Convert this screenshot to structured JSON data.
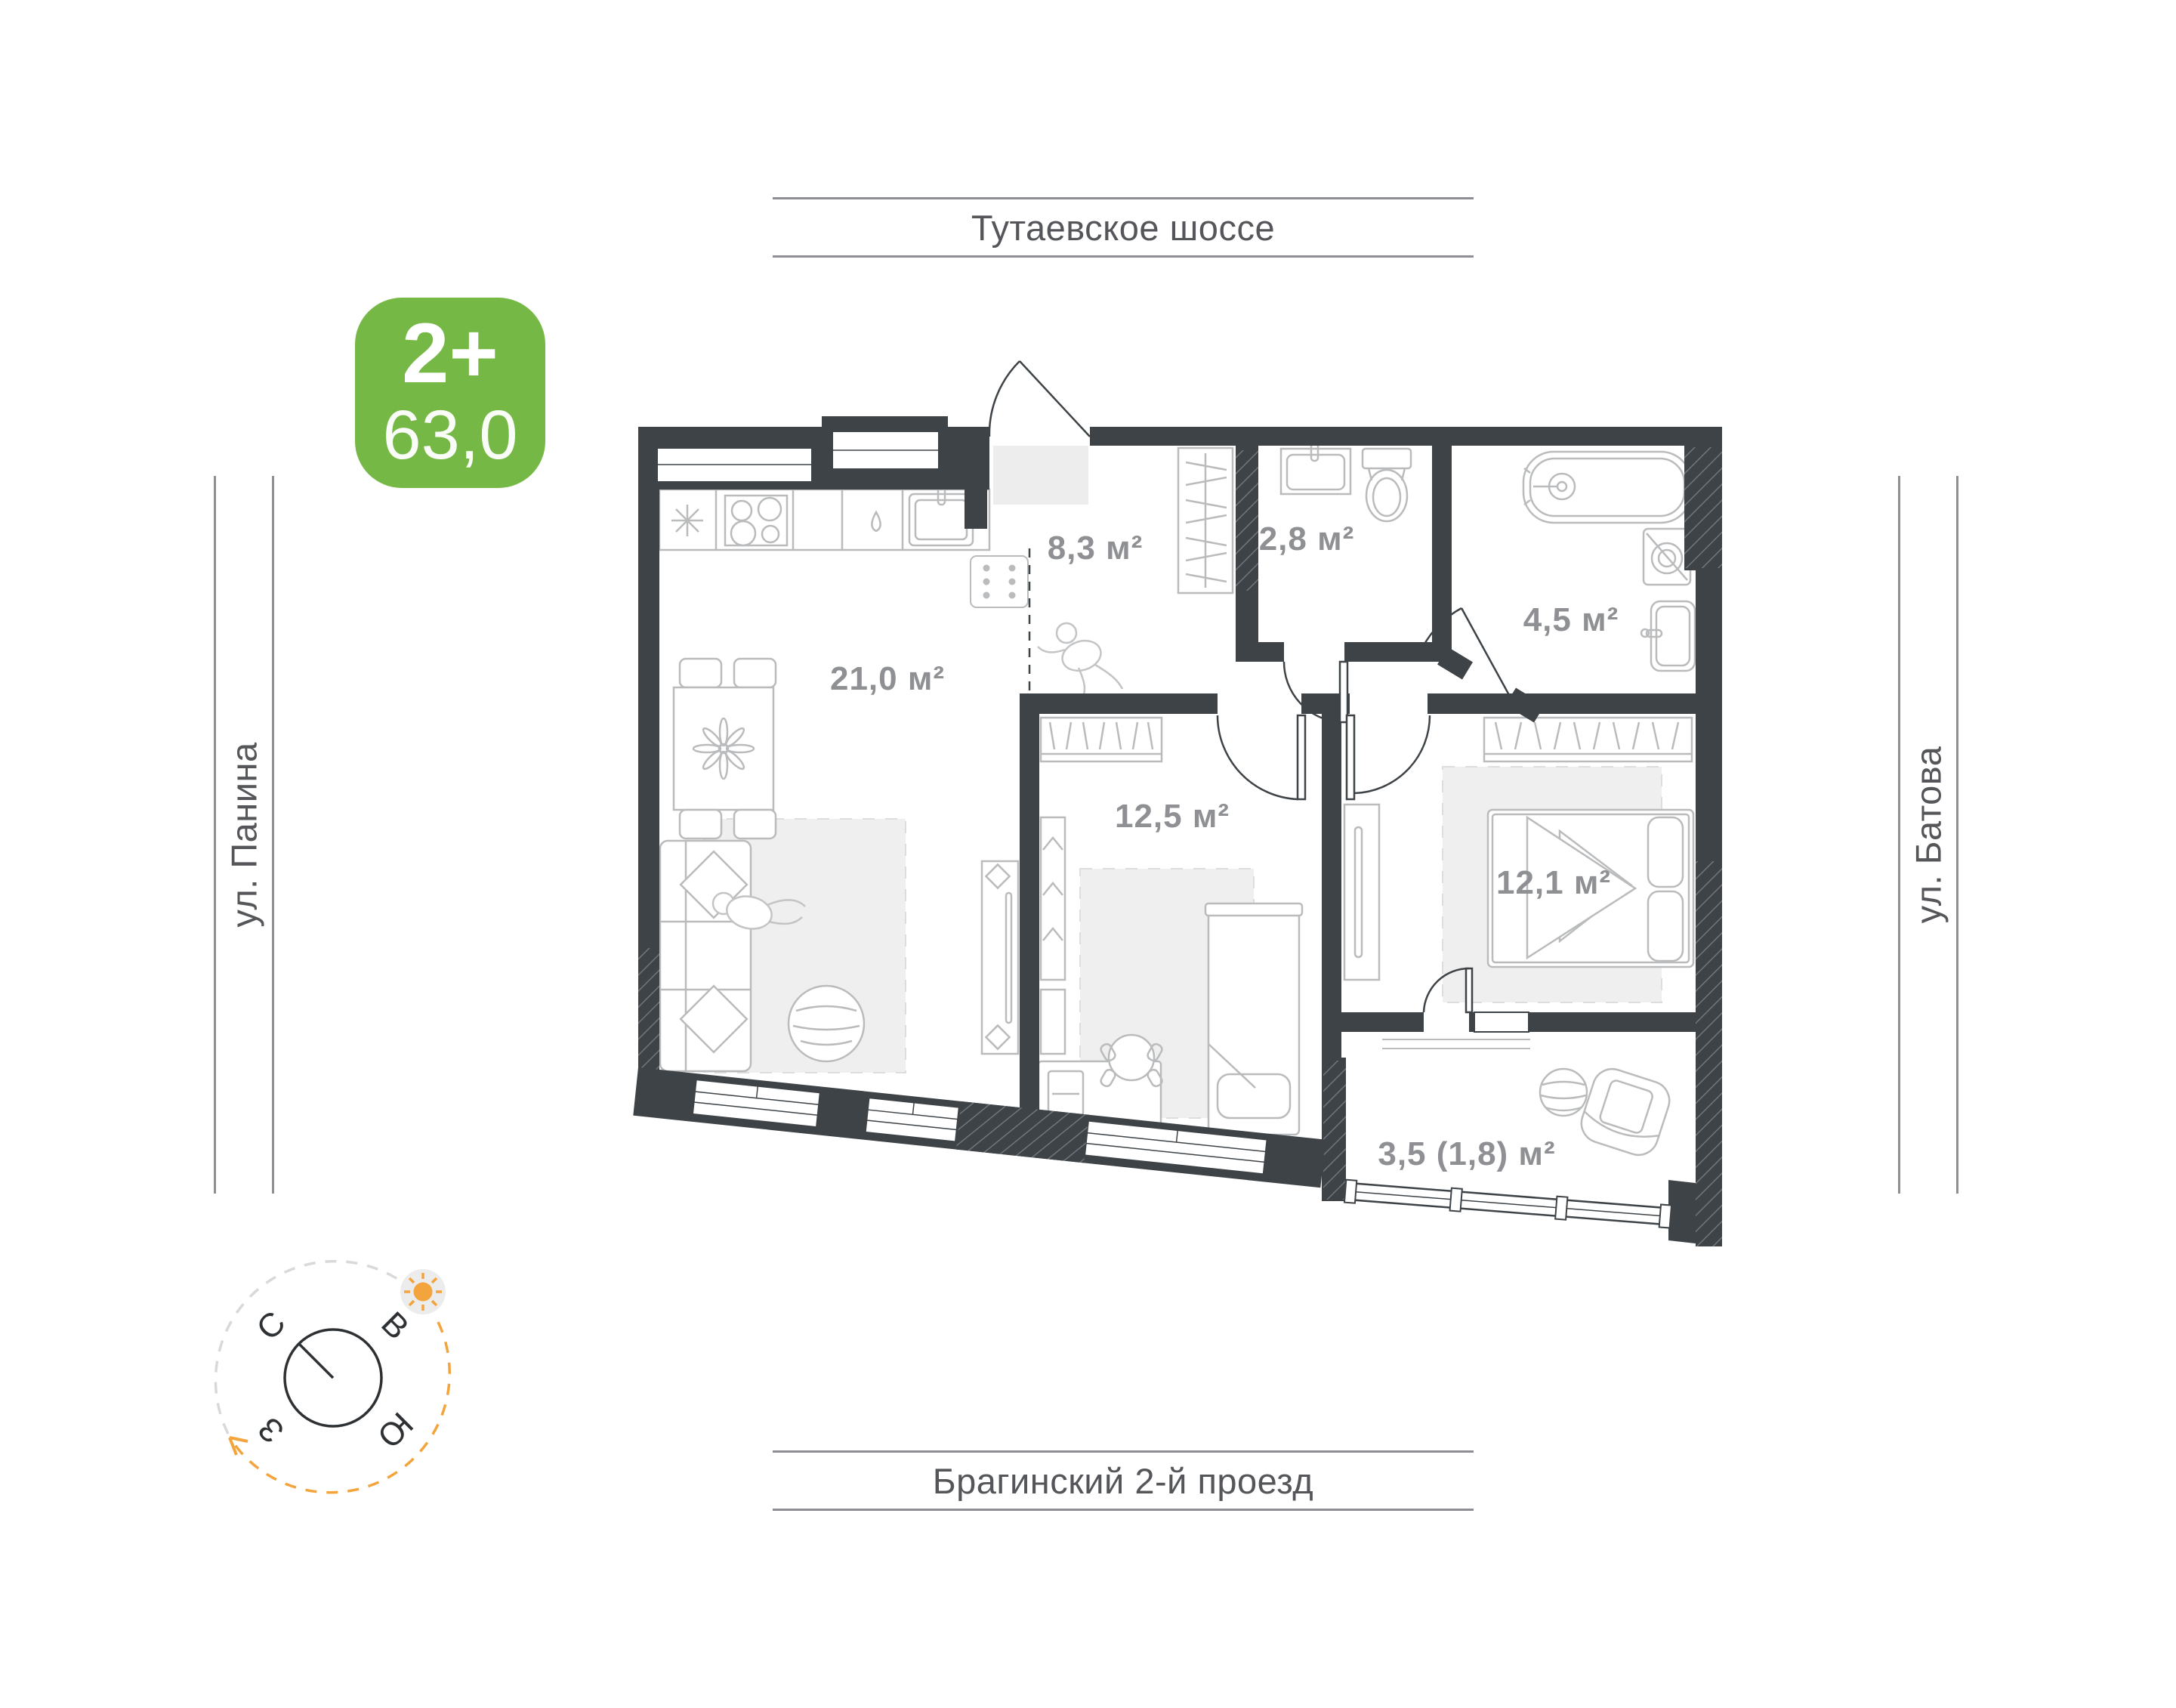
{
  "page": {
    "title": "Floor plan 2+ 63,0"
  },
  "badge": {
    "type_label": "2+",
    "area_value": "63,0",
    "color": "#76b845"
  },
  "streets": {
    "top": "Тутаевское шоссе",
    "bottom": "Брагинский 2-й проезд",
    "left": "ул. Панина",
    "right": "ул. Батова"
  },
  "plan": {
    "rooms": [
      {
        "name": "kitchen-living",
        "area_label": "21,0 м²"
      },
      {
        "name": "hallway",
        "area_label": "8,3 м²"
      },
      {
        "name": "wc",
        "area_label": "2,8 м²"
      },
      {
        "name": "bathroom",
        "area_label": "4,5 м²"
      },
      {
        "name": "child-bedroom",
        "area_label": "12,5 м²"
      },
      {
        "name": "bedroom",
        "area_label": "12,1 м²"
      },
      {
        "name": "balcony",
        "area_label": "3,5 (1,8) м²"
      }
    ]
  },
  "compass": {
    "north": "С",
    "east": "В",
    "south": "Ю",
    "west": "З"
  },
  "colors": {
    "wall": "#3e4347",
    "furniture_line": "#b9bbbd",
    "rug": "#efefef",
    "room_label": "#8f9093",
    "street_text": "#54565a",
    "badge_green": "#76b845",
    "accent_orange": "#f3a43c"
  }
}
